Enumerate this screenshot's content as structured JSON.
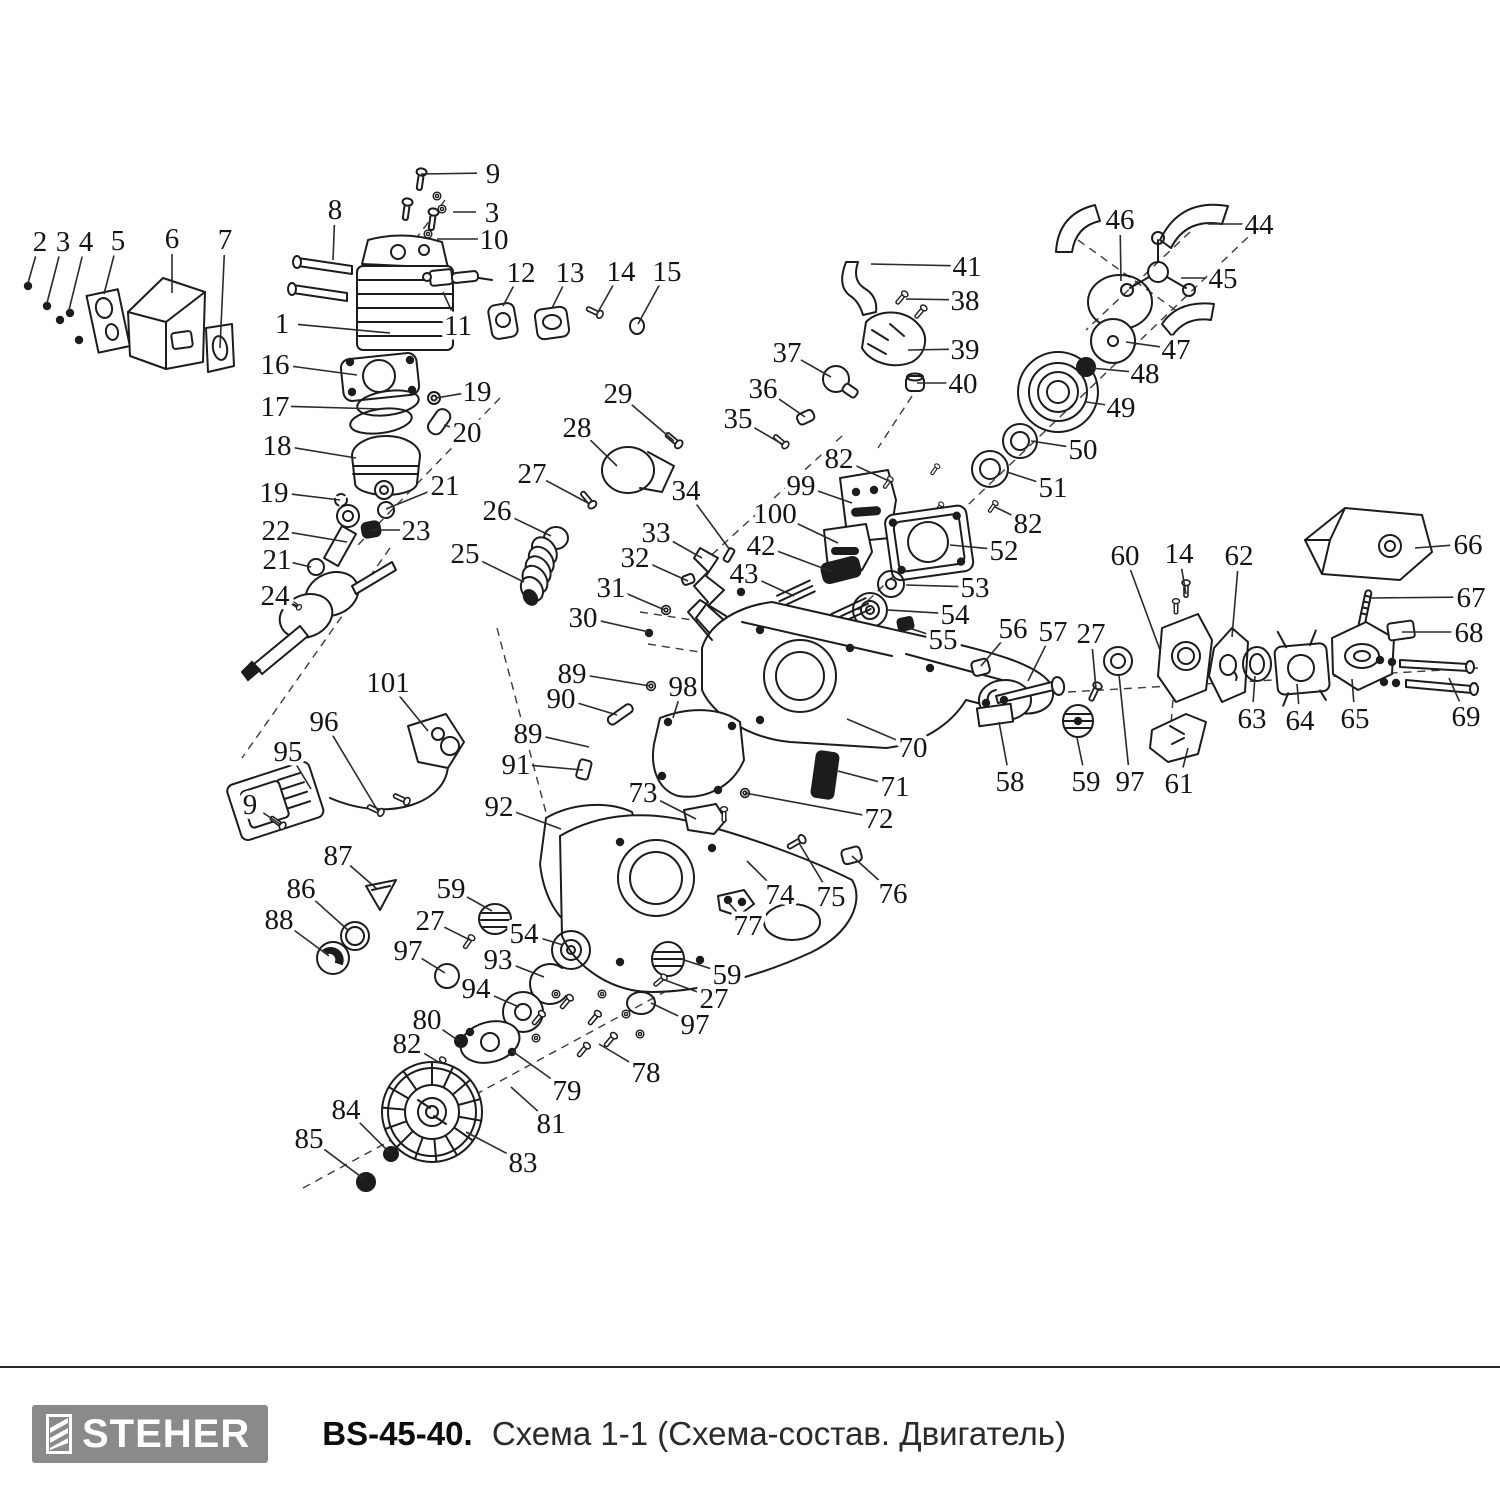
{
  "footer": {
    "brand": "STEHER",
    "model": "BS-45-40.",
    "subtitle": "Схема 1-1 (Схема-состав. Двигатель)",
    "logo_bg": "#8a8a8c",
    "logo_text_color": "#ffffff"
  },
  "diagram": {
    "description": "Exploded parts diagram of chainsaw engine",
    "line_color": "#1c1c1c",
    "callouts": [
      {
        "n": "2",
        "x": 40,
        "y": 241,
        "tx": 28,
        "ty": 283
      },
      {
        "n": "3",
        "x": 63,
        "y": 241,
        "tx": 47,
        "ty": 303
      },
      {
        "n": "4",
        "x": 86,
        "y": 241,
        "tx": 69,
        "ty": 310
      },
      {
        "n": "5",
        "x": 118,
        "y": 240,
        "tx": 104,
        "ty": 294
      },
      {
        "n": "6",
        "x": 172,
        "y": 238,
        "tx": 172,
        "ty": 293
      },
      {
        "n": "7",
        "x": 225,
        "y": 239,
        "tx": 220,
        "ty": 348
      },
      {
        "n": "8",
        "x": 335,
        "y": 209,
        "tx": 333,
        "ty": 260
      },
      {
        "n": "9",
        "x": 493,
        "y": 173,
        "tx": 421,
        "ty": 174
      },
      {
        "n": "3",
        "x": 492,
        "y": 212,
        "tx": 453,
        "ty": 212
      },
      {
        "n": "10",
        "x": 494,
        "y": 239,
        "tx": 437,
        "ty": 239
      },
      {
        "n": "12",
        "x": 521,
        "y": 272,
        "tx": 503,
        "ty": 306
      },
      {
        "n": "13",
        "x": 570,
        "y": 272,
        "tx": 552,
        "ty": 308
      },
      {
        "n": "14",
        "x": 621,
        "y": 271,
        "tx": 597,
        "ty": 314
      },
      {
        "n": "15",
        "x": 667,
        "y": 271,
        "tx": 638,
        "ty": 324
      },
      {
        "n": "1",
        "x": 282,
        "y": 323,
        "tx": 390,
        "ty": 333
      },
      {
        "n": "11",
        "x": 458,
        "y": 325,
        "tx": 443,
        "ty": 292
      },
      {
        "n": "16",
        "x": 275,
        "y": 364,
        "tx": 357,
        "ty": 375
      },
      {
        "n": "17",
        "x": 275,
        "y": 406,
        "tx": 380,
        "ty": 409
      },
      {
        "n": "19",
        "x": 477,
        "y": 391,
        "tx": 436,
        "ty": 398
      },
      {
        "n": "20",
        "x": 467,
        "y": 432,
        "tx": 444,
        "ty": 425
      },
      {
        "n": "18",
        "x": 277,
        "y": 445,
        "tx": 356,
        "ty": 458
      },
      {
        "n": "19",
        "x": 274,
        "y": 492,
        "tx": 340,
        "ty": 500
      },
      {
        "n": "21",
        "x": 445,
        "y": 485,
        "tx": 386,
        "ty": 509
      },
      {
        "n": "22",
        "x": 276,
        "y": 530,
        "tx": 347,
        "ty": 542
      },
      {
        "n": "23",
        "x": 416,
        "y": 530,
        "tx": 371,
        "ty": 530
      },
      {
        "n": "21",
        "x": 277,
        "y": 559,
        "tx": 311,
        "ty": 567
      },
      {
        "n": "24",
        "x": 275,
        "y": 595,
        "tx": 297,
        "ty": 606
      },
      {
        "n": "25",
        "x": 465,
        "y": 553,
        "tx": 524,
        "ty": 582
      },
      {
        "n": "26",
        "x": 497,
        "y": 510,
        "tx": 551,
        "ty": 536
      },
      {
        "n": "27",
        "x": 532,
        "y": 473,
        "tx": 588,
        "ty": 503
      },
      {
        "n": "28",
        "x": 577,
        "y": 427,
        "tx": 617,
        "ty": 466
      },
      {
        "n": "29",
        "x": 618,
        "y": 393,
        "tx": 674,
        "ty": 441
      },
      {
        "n": "30",
        "x": 583,
        "y": 617,
        "tx": 649,
        "ty": 632
      },
      {
        "n": "31",
        "x": 611,
        "y": 587,
        "tx": 665,
        "ty": 610
      },
      {
        "n": "32",
        "x": 635,
        "y": 557,
        "tx": 688,
        "ty": 581
      },
      {
        "n": "33",
        "x": 656,
        "y": 532,
        "tx": 702,
        "ty": 558
      },
      {
        "n": "34",
        "x": 686,
        "y": 490,
        "tx": 730,
        "ty": 550
      },
      {
        "n": "35",
        "x": 738,
        "y": 418,
        "tx": 782,
        "ty": 444
      },
      {
        "n": "36",
        "x": 763,
        "y": 388,
        "tx": 805,
        "ty": 417
      },
      {
        "n": "37",
        "x": 787,
        "y": 352,
        "tx": 831,
        "ty": 377
      },
      {
        "n": "38",
        "x": 965,
        "y": 300,
        "tx": 906,
        "ty": 299
      },
      {
        "n": "39",
        "x": 965,
        "y": 349,
        "tx": 908,
        "ty": 350
      },
      {
        "n": "40",
        "x": 963,
        "y": 383,
        "tx": 917,
        "ty": 383
      },
      {
        "n": "41",
        "x": 967,
        "y": 266,
        "tx": 871,
        "ty": 264
      },
      {
        "n": "42",
        "x": 761,
        "y": 545,
        "tx": 833,
        "ty": 572
      },
      {
        "n": "43",
        "x": 744,
        "y": 573,
        "tx": 794,
        "ty": 596
      },
      {
        "n": "44",
        "x": 1259,
        "y": 224,
        "tx": 1208,
        "ty": 224
      },
      {
        "n": "45",
        "x": 1223,
        "y": 278,
        "tx": 1181,
        "ty": 278
      },
      {
        "n": "46",
        "x": 1120,
        "y": 219,
        "tx": 1121,
        "ty": 281
      },
      {
        "n": "47",
        "x": 1176,
        "y": 349,
        "tx": 1126,
        "ty": 342
      },
      {
        "n": "48",
        "x": 1145,
        "y": 373,
        "tx": 1091,
        "ty": 368
      },
      {
        "n": "49",
        "x": 1121,
        "y": 407,
        "tx": 1086,
        "ty": 402
      },
      {
        "n": "50",
        "x": 1083,
        "y": 449,
        "tx": 1031,
        "ty": 441
      },
      {
        "n": "51",
        "x": 1053,
        "y": 487,
        "tx": 1007,
        "ty": 472
      },
      {
        "n": "82",
        "x": 839,
        "y": 458,
        "tx": 889,
        "ty": 481
      },
      {
        "n": "82",
        "x": 1028,
        "y": 523,
        "tx": 995,
        "ty": 507
      },
      {
        "n": "99",
        "x": 801,
        "y": 485,
        "tx": 852,
        "ty": 503
      },
      {
        "n": "100",
        "x": 775,
        "y": 513,
        "tx": 838,
        "ty": 543
      },
      {
        "n": "52",
        "x": 1004,
        "y": 550,
        "tx": 950,
        "ty": 545
      },
      {
        "n": "53",
        "x": 975,
        "y": 587,
        "tx": 906,
        "ty": 585
      },
      {
        "n": "54",
        "x": 955,
        "y": 614,
        "tx": 888,
        "ty": 610
      },
      {
        "n": "55",
        "x": 943,
        "y": 639,
        "tx": 909,
        "ty": 628
      },
      {
        "n": "56",
        "x": 1013,
        "y": 628,
        "tx": 981,
        "ty": 666
      },
      {
        "n": "57",
        "x": 1053,
        "y": 631,
        "tx": 1028,
        "ty": 681
      },
      {
        "n": "27",
        "x": 1091,
        "y": 633,
        "tx": 1096,
        "ty": 689
      },
      {
        "n": "60",
        "x": 1125,
        "y": 555,
        "tx": 1160,
        "ty": 650
      },
      {
        "n": "14",
        "x": 1179,
        "y": 553,
        "tx": 1186,
        "ty": 594
      },
      {
        "n": "62",
        "x": 1239,
        "y": 555,
        "tx": 1232,
        "ty": 637
      },
      {
        "n": "66",
        "x": 1468,
        "y": 544,
        "tx": 1415,
        "ty": 548
      },
      {
        "n": "67",
        "x": 1471,
        "y": 597,
        "tx": 1371,
        "ty": 598
      },
      {
        "n": "68",
        "x": 1469,
        "y": 632,
        "tx": 1402,
        "ty": 632
      },
      {
        "n": "63",
        "x": 1252,
        "y": 718,
        "tx": 1255,
        "ty": 676
      },
      {
        "n": "64",
        "x": 1300,
        "y": 720,
        "tx": 1297,
        "ty": 684
      },
      {
        "n": "65",
        "x": 1355,
        "y": 718,
        "tx": 1352,
        "ty": 679
      },
      {
        "n": "69",
        "x": 1466,
        "y": 716,
        "tx": 1449,
        "ty": 678
      },
      {
        "n": "58",
        "x": 1010,
        "y": 781,
        "tx": 999,
        "ty": 722
      },
      {
        "n": "59",
        "x": 1086,
        "y": 781,
        "tx": 1077,
        "ty": 738
      },
      {
        "n": "97",
        "x": 1130,
        "y": 781,
        "tx": 1119,
        "ty": 675
      },
      {
        "n": "61",
        "x": 1179,
        "y": 783,
        "tx": 1188,
        "ty": 748
      },
      {
        "n": "89",
        "x": 572,
        "y": 673,
        "tx": 650,
        "ty": 686
      },
      {
        "n": "90",
        "x": 561,
        "y": 698,
        "tx": 617,
        "ty": 715
      },
      {
        "n": "98",
        "x": 683,
        "y": 686,
        "tx": 673,
        "ty": 718
      },
      {
        "n": "70",
        "x": 913,
        "y": 747,
        "tx": 847,
        "ty": 719
      },
      {
        "n": "71",
        "x": 895,
        "y": 786,
        "tx": 838,
        "ty": 771
      },
      {
        "n": "72",
        "x": 879,
        "y": 818,
        "tx": 745,
        "ty": 793
      },
      {
        "n": "73",
        "x": 643,
        "y": 792,
        "tx": 696,
        "ty": 819
      },
      {
        "n": "74",
        "x": 780,
        "y": 894,
        "tx": 747,
        "ty": 861
      },
      {
        "n": "75",
        "x": 831,
        "y": 896,
        "tx": 799,
        "ty": 843
      },
      {
        "n": "76",
        "x": 893,
        "y": 893,
        "tx": 852,
        "ty": 856
      },
      {
        "n": "77",
        "x": 748,
        "y": 925,
        "tx": 728,
        "ty": 902
      },
      {
        "n": "101",
        "x": 388,
        "y": 682,
        "tx": 428,
        "ty": 731
      },
      {
        "n": "96",
        "x": 324,
        "y": 721,
        "tx": 378,
        "ty": 811
      },
      {
        "n": "95",
        "x": 288,
        "y": 751,
        "tx": 311,
        "ty": 789
      },
      {
        "n": "9",
        "x": 250,
        "y": 804,
        "tx": 280,
        "ty": 824
      },
      {
        "n": "89",
        "x": 528,
        "y": 733,
        "tx": 589,
        "ty": 747
      },
      {
        "n": "91",
        "x": 516,
        "y": 764,
        "tx": 583,
        "ty": 770
      },
      {
        "n": "92",
        "x": 499,
        "y": 806,
        "tx": 561,
        "ty": 829
      },
      {
        "n": "87",
        "x": 338,
        "y": 855,
        "tx": 377,
        "ty": 889
      },
      {
        "n": "86",
        "x": 301,
        "y": 888,
        "tx": 349,
        "ty": 931
      },
      {
        "n": "88",
        "x": 279,
        "y": 919,
        "tx": 329,
        "ty": 956
      },
      {
        "n": "59",
        "x": 451,
        "y": 888,
        "tx": 492,
        "ty": 911
      },
      {
        "n": "27",
        "x": 430,
        "y": 920,
        "tx": 470,
        "ty": 940
      },
      {
        "n": "54",
        "x": 524,
        "y": 933,
        "tx": 563,
        "ty": 945
      },
      {
        "n": "97",
        "x": 408,
        "y": 950,
        "tx": 445,
        "ty": 973
      },
      {
        "n": "93",
        "x": 498,
        "y": 959,
        "tx": 544,
        "ty": 977
      },
      {
        "n": "94",
        "x": 476,
        "y": 988,
        "tx": 519,
        "ty": 1007
      },
      {
        "n": "80",
        "x": 427,
        "y": 1019,
        "tx": 459,
        "ty": 1041
      },
      {
        "n": "82",
        "x": 407,
        "y": 1043,
        "tx": 440,
        "ty": 1063
      },
      {
        "n": "79",
        "x": 567,
        "y": 1090,
        "tx": 512,
        "ty": 1051
      },
      {
        "n": "81",
        "x": 551,
        "y": 1123,
        "tx": 511,
        "ty": 1087
      },
      {
        "n": "78",
        "x": 646,
        "y": 1072,
        "tx": 599,
        "ty": 1044
      },
      {
        "n": "83",
        "x": 523,
        "y": 1162,
        "tx": 466,
        "ty": 1132
      },
      {
        "n": "84",
        "x": 346,
        "y": 1109,
        "tx": 389,
        "ty": 1152
      },
      {
        "n": "85",
        "x": 309,
        "y": 1138,
        "tx": 364,
        "ty": 1179
      },
      {
        "n": "59",
        "x": 727,
        "y": 974,
        "tx": 681,
        "ty": 959
      },
      {
        "n": "27",
        "x": 714,
        "y": 998,
        "tx": 662,
        "ty": 979
      },
      {
        "n": "97",
        "x": 695,
        "y": 1024,
        "tx": 651,
        "ty": 1003
      }
    ]
  }
}
